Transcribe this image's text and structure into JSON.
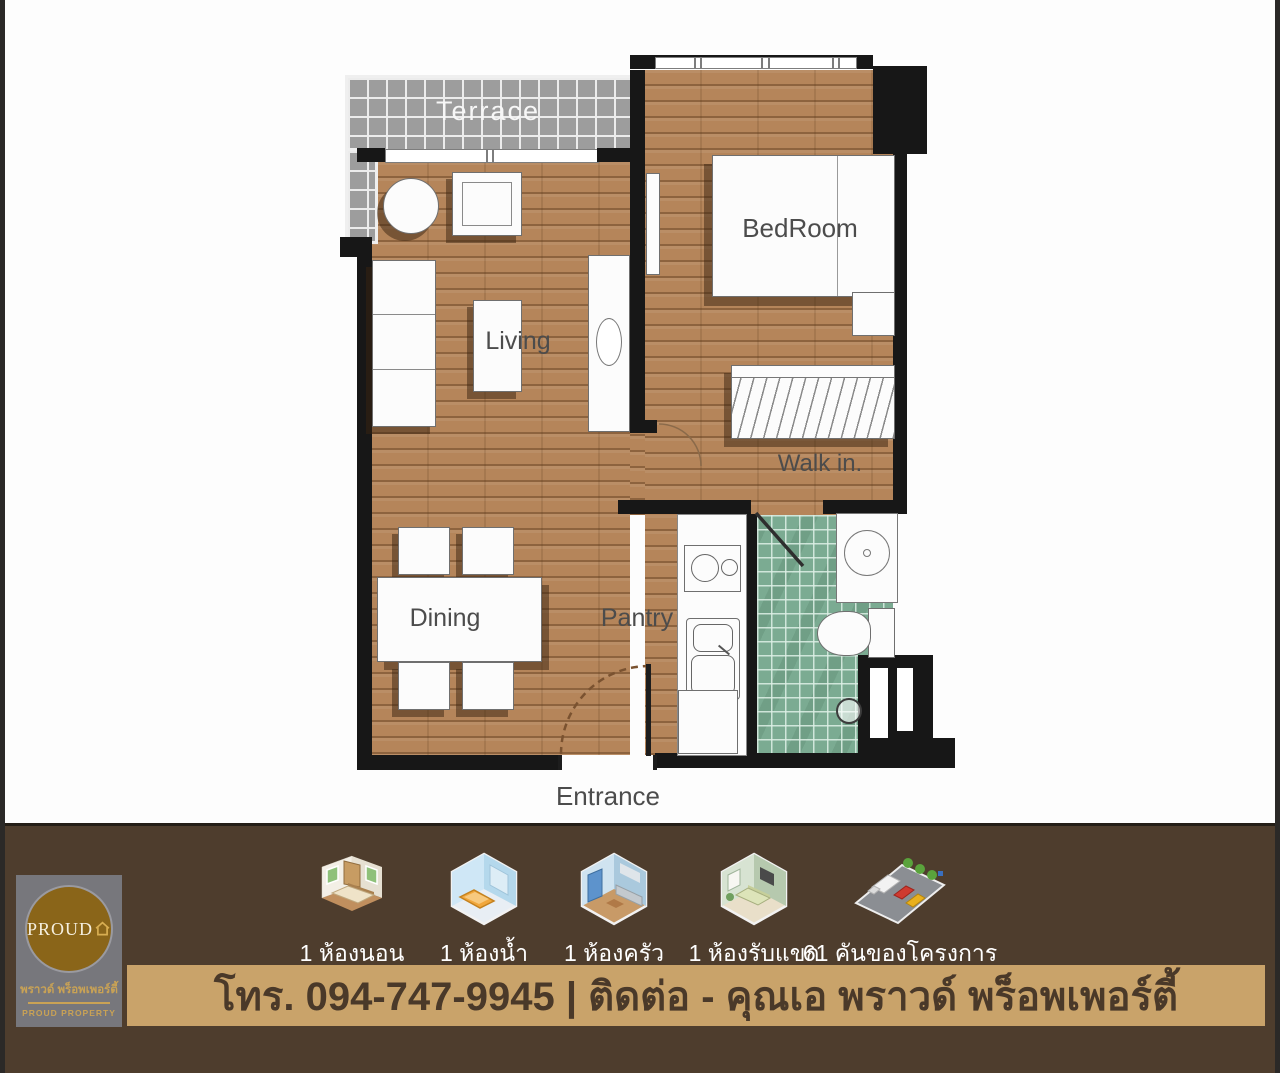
{
  "plan": {
    "labels": {
      "terrace": "Terrace",
      "bedroom": "BedRoom",
      "living": "Living",
      "walkin": "Walk in.",
      "dining": "Dining",
      "pantry": "Pantry",
      "entrance": "Entrance"
    }
  },
  "footer": {
    "logo": {
      "brand": "PROUD",
      "thai_name": "พราวด์ พร็อพเพอร์ตี้",
      "subtitle": "PROUD PROPERTY"
    },
    "features": [
      {
        "icon": "bedroom-icon",
        "label": "1 ห้องนอน"
      },
      {
        "icon": "bathroom-icon",
        "label": "1 ห้องน้ำ"
      },
      {
        "icon": "kitchen-icon",
        "label": "1 ห้องครัว"
      },
      {
        "icon": "living-room-icon",
        "label": "1 ห้องรับแขก"
      },
      {
        "icon": "parking-icon",
        "label": "61 คันของโครงการ"
      }
    ],
    "contact": "โทร. 094-747-9945 | ติดต่อ - คุณเอ พราวด์ พร็อพเพอร์ตี้"
  },
  "colors": {
    "footer_bg": "#4e3d2d",
    "contact_strip_bg": "#c9a36a",
    "contact_text": "#4a3929",
    "wood_floor": "#b5855a",
    "bath_tile": "#7bab92",
    "terrace_tile": "#9d9d9d",
    "wall": "#171717",
    "logo_gold": "#c9a255",
    "logo_circle": "#8a6519",
    "logo_bg": "#77777c"
  }
}
